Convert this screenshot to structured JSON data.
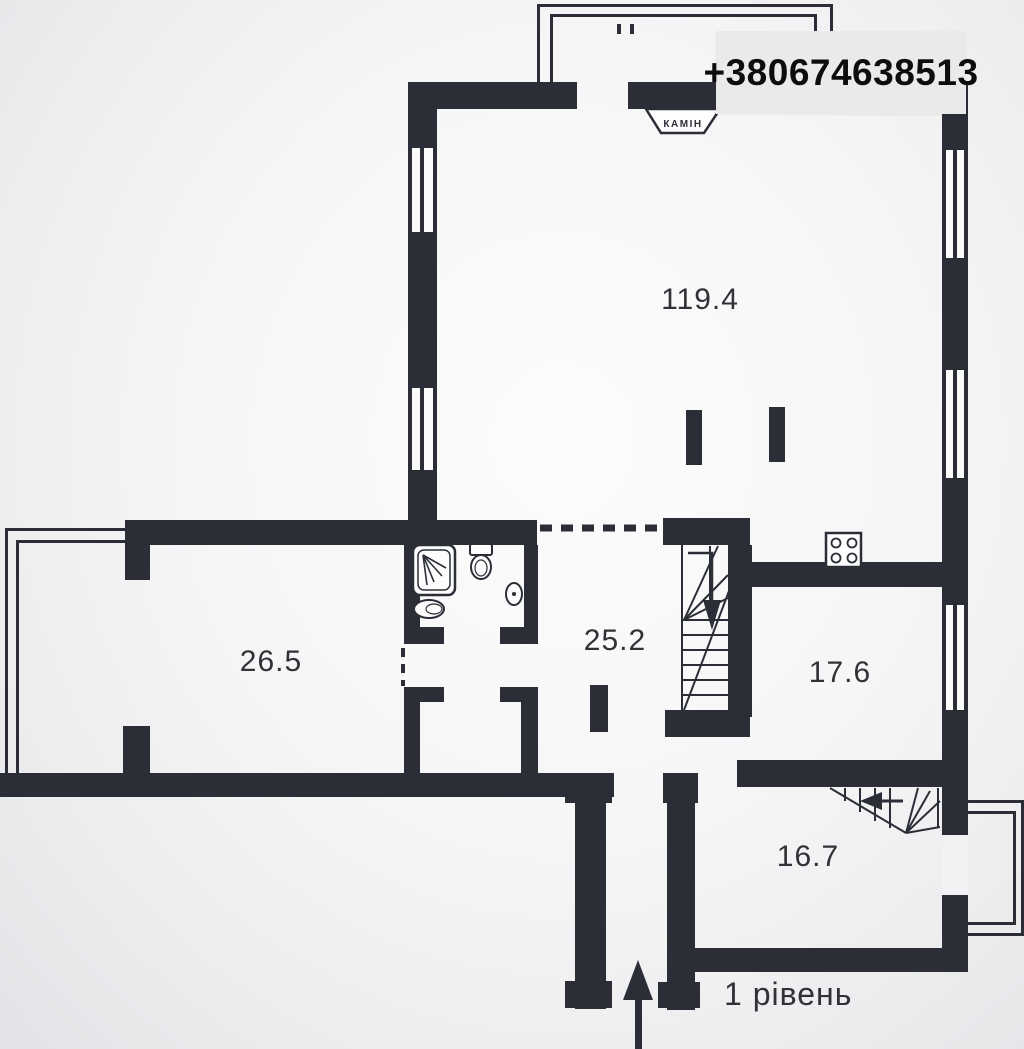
{
  "header": {
    "phone": "+380674638513"
  },
  "plan": {
    "level_label": "1 рівень",
    "fireplace_label": "КАМІН",
    "rooms": {
      "living": {
        "area": "119.4"
      },
      "bedroom": {
        "area": "26.5"
      },
      "hall": {
        "area": "25.2"
      },
      "kitchen": {
        "area": "17.6"
      },
      "entry": {
        "area": "16.7"
      }
    }
  },
  "colors": {
    "wall": "#2b2e37",
    "label_text": "#2f3237",
    "phone_box_bg": "#eaeaea",
    "phone_text": "#0d0d0f",
    "floor_white": "#fbfbfc",
    "background_gray": "#e9eaec"
  }
}
